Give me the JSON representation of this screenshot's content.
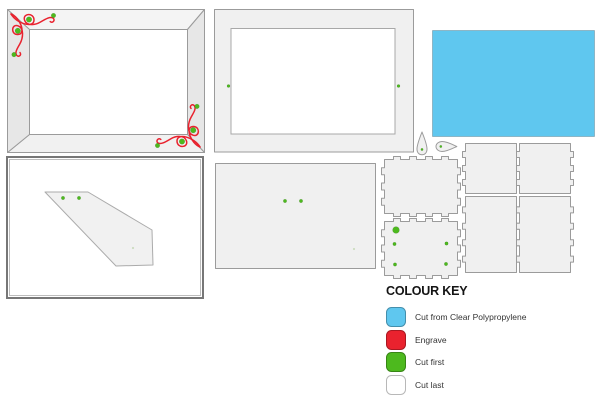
{
  "colour_key": {
    "title": "COLOUR KEY",
    "entries": [
      {
        "label": "Cut from Clear Polypropylene",
        "color": "#5FC7EF"
      },
      {
        "label": "Engrave",
        "color": "#E9222E"
      },
      {
        "label": "Cut first",
        "color": "#4DB91E"
      },
      {
        "label": "Cut last",
        "color": "#FFFFFF"
      }
    ]
  },
  "colors": {
    "polypropylene": "#5FC7EF",
    "engrave": "#E9222E",
    "cut_first": "#4DB91E",
    "cut_last": "#FFFFFF",
    "sheet_fill": "#F0F0F0",
    "sheet_outline": "#9B9B9B"
  }
}
